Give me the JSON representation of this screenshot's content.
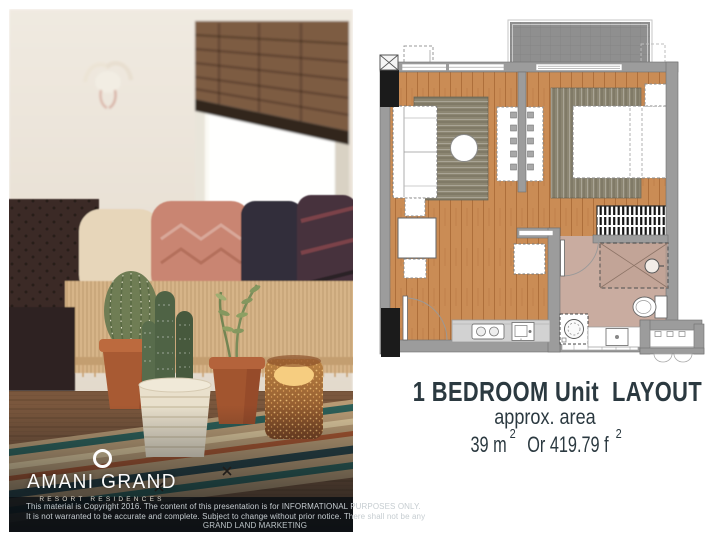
{
  "canvas": {
    "width": 720,
    "height": 540,
    "background": "#ffffff"
  },
  "photo": {
    "logo": {
      "icon": "ring-icon",
      "brand": "AMANI GRAND",
      "subtitle": "RESORT RESIDENCES"
    },
    "disclaimer": {
      "line1": "This material is Copyright 2016. The content of this presentation is for INFORMATIONAL PURPOSES ONLY.",
      "line2": "It is not warranted to be accurate and complete. Subject to change without prior notice. There shall not be any",
      "line3": "GRAND LAND MARKETING"
    }
  },
  "floorplan": {
    "caption": {
      "title": "1 BEDROOM Unit  LAYOUT",
      "subtitle": "approx. area",
      "area_metric": "39 m",
      "area_metric_sup": "2",
      "area_joiner": " Or 419.79 f",
      "area_imperial_sup": "2"
    },
    "colors": {
      "wall": "#9c9c9c",
      "wood_floor": "#ca8c55",
      "bath_floor": "#c9aca0",
      "balcony_floor": "#8f8f8f",
      "rug": "#8c8672",
      "service_column": "#1b1b1b",
      "caption_text": "#2b3940"
    },
    "furniture_icons": [
      "sofa-icon",
      "round-table-icon",
      "tv-cabinet-icon",
      "dining-set-icon",
      "bed-icon",
      "nightstand-icon",
      "wardrobe-icon",
      "shower-icon",
      "toilet-icon",
      "lavatory-icon",
      "washing-machine-icon",
      "stove-icon",
      "kitchen-sink-icon",
      "entry-door-icon",
      "bathroom-door-icon",
      "ac-unit-icon",
      "balcony-icon",
      "service-column-icon"
    ]
  }
}
